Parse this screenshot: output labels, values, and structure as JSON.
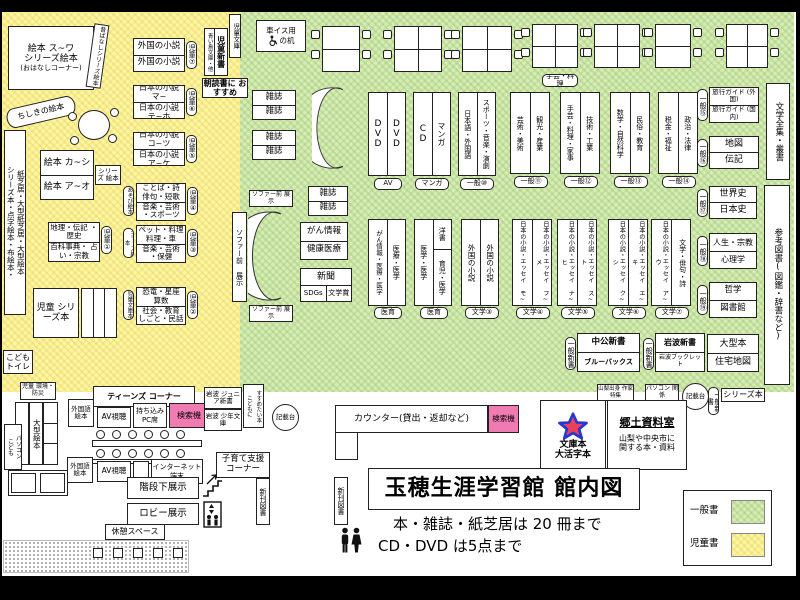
{
  "colors": {
    "general_green": "#d7ecb6",
    "children_yellow": "#fdf6a3",
    "search_pink": "#f07ab2",
    "star_fill": "#e8415c",
    "star_stroke": "#2437d4"
  },
  "labels": {
    "zasshi": "雑誌",
    "shinbun": "新聞",
    "sdgs": "SDGs",
    "bungakusho": "文学賞",
    "av_shicho": "AV視聴",
    "gaikokugo_ehon": "外国語 絵本",
    "kensakuki": "検索機",
    "kisaidai": "記載台",
    "sofa_front": "ソファー前 展示",
    "shinkan": "新刊図書",
    "ippan_shinsho": "一般新書",
    "iiku": "医育",
    "av": "AV",
    "manga": "マンガ"
  },
  "children": {
    "ohanashi": {
      "line1": "絵本 ス~ワ",
      "line2": "シリーズ絵本",
      "line3": "(おはなしコーナー)"
    },
    "mukashi": "昔ばなしシリーズ絵本",
    "chishiki": "ちしきの絵本",
    "left_wall": {
      "line1": "シリーズ本・点字絵本・布絵本・",
      "line2": "紙芝居・大型紙芝居・大型絵本"
    },
    "ehon_ka_shi": {
      "top": "絵本 カ~シ",
      "bottom": "絵本 ア~オ",
      "side": "シリーズ 絵本"
    },
    "foreign_novels": {
      "top": "外国の小説",
      "bottom": "外国の小説",
      "tag": "児童⑦"
    },
    "jidou_shinsho": {
      "main": "児童新書",
      "side": "青い鳥文庫・他",
      "strip": "児童文庫",
      "tag": "朝読書に おすすめ"
    },
    "jp_novels_1": {
      "top": "日本の小説 マ~",
      "bottom": "日本の小説 テ~ホ",
      "tag": "児童⑥"
    },
    "jp_novels_2": {
      "top": "日本の小説 コ~ツ",
      "bottom": "日本の小説 ア~ケ",
      "tag": "児童⑤"
    },
    "kotoba": {
      "top": "ことば・詩 俳句・短歌",
      "bottom": "音楽・芸術 ・スポーツ",
      "tag": "児童④",
      "side": "あそび絵本"
    },
    "pet": {
      "top": "ペット・料理 料理・車",
      "bottom": "音楽・芸術 ・保健",
      "tag": "児童③",
      "side": "シリーズ絵本"
    },
    "kyoryu": {
      "top": "恐竜・星座 算数",
      "bottom": "社会・教育 しごと・民話",
      "tag": "児童②",
      "side": "児童文庫本"
    },
    "chiri": {
      "top": "地理・伝記 ・歴史",
      "bottom": "百科事典・ 占い・宗教",
      "tag": "児童①"
    },
    "jidou_series": "児童 シリーズ本",
    "kodomo_toilet": "こども トイレ",
    "kankyo": "児童 環境・防災",
    "ogata_ehon": "大型絵本",
    "kodomo_pc": {
      "line1": "こども",
      "line2": "パソコン"
    },
    "teens": "ティーンズ コーナー",
    "mochikomi_pc": "持ち込み PC席",
    "iwanami_junior": "岩波 ジュニア新書",
    "iwanami_shonen": "岩波 少年文庫",
    "susume": {
      "line1": "こどもに",
      "line2": "すすめたい本"
    },
    "internet": "インターネット 端末",
    "kosodate": "子育て支援 コーナー"
  },
  "general": {
    "wheelchair_desk": {
      "line1": "車イス用",
      "line2": "の机"
    },
    "shugei_tag": "手芸・料理",
    "row1": [
      {
        "left": "DVD",
        "right": "DVD",
        "tag": "AV"
      },
      {
        "left": "CD",
        "right": "マンガ",
        "tag": "マンガ"
      },
      {
        "left": "日本語・外国語",
        "right": "スポーツ・音楽・演劇",
        "tag": "一般⑩"
      },
      {
        "left": "芸術・美術",
        "right": "観光・産業",
        "tag": "一般⑪"
      },
      {
        "left": "手芸・料理・家事",
        "right": "技術・工業",
        "tag": "一般⑫"
      },
      {
        "left": "数学・自然科学",
        "right": "民俗・教育",
        "tag": "一般⑬"
      },
      {
        "left": "税金・福祉",
        "right": "政治・法律",
        "tag": "一般⑭"
      }
    ],
    "row2": [
      {
        "left": "がん情報・医療・医学",
        "right": "医療・医学",
        "tag": "医育"
      },
      {
        "left": "医学・医学",
        "rtop": "洋書",
        "rbottom": "育児・医学",
        "tag": "医育"
      },
      {
        "left": "外国の小説",
        "right": "外国の小説",
        "tag": "文学③"
      },
      {
        "left": "日本の小説・エッセイ モ~",
        "right": "日本の小説・エッセイ フ~メ",
        "tag": "文学④"
      },
      {
        "left": "日本の小説・エッセイ ナ~ヒ",
        "right": "日本の小説・エッセイ ス~ト",
        "tag": "文学⑤"
      },
      {
        "left": "日本の小説・エッセイ ク~シ",
        "right": "日本の小説・エッセイ エ~キ",
        "tag": "文学⑥"
      },
      {
        "left": "日本の小説・エッセイ ア~ウ",
        "right": "文学・俳句・詩",
        "tag": "文学⑦"
      }
    ],
    "right_col": [
      {
        "tag": "一般⑮",
        "top": "旅行ガイド (外国)",
        "bottom": "旅行ガイド (国内)"
      },
      {
        "tag": "一般⑯",
        "top": "地図",
        "bottom": "伝記"
      },
      {
        "tag": "一般⑰",
        "top": "世界史",
        "bottom": "日本史"
      },
      {
        "tag": "一般⑱",
        "top": "人生・宗教",
        "bottom": "心理学"
      },
      {
        "tag": "一般⑲",
        "top": "哲学",
        "bottom": "図書館"
      }
    ],
    "chuko": {
      "top": "中公新書",
      "bottom": "ブルーバックス"
    },
    "iwanami": {
      "top": "岩波新書",
      "bottom": "岩波ブックレット"
    },
    "ogata_jutaku": {
      "top": "大型本",
      "bottom": "住宅地図"
    },
    "bungaku_zenshu": "文学全集・叢書",
    "sanko_tosho": "参考図書(図鑑・辞書など)",
    "gan_box": {
      "top": "がん情報",
      "bottom": "健康医療"
    },
    "shinbun_box": {
      "top": "新聞",
      "bl": "SDGs",
      "br": "文学賞"
    },
    "yamanashi_tag": "山梨出身 作家特集",
    "pc_kankei": "パソコン 関係",
    "series_bon": "シリーズ本",
    "kyodo": {
      "title": "郷土資料室",
      "body1": "山梨や中央市に",
      "body2": "関する本・資料"
    },
    "bunko": {
      "line1": "文庫本",
      "line2": "大活字本"
    },
    "counter": "カウンター(貸出・返却など)"
  },
  "bottom": {
    "kaidan": "階段下展示",
    "lobby": "ロビー展示",
    "kyukei": "休憩スペース",
    "title": "玉穂生涯学習館 館内図",
    "rule1": "本・雑誌・紙芝居は 20 冊まで",
    "rule2": "CD・DVD は5点まで",
    "legend_general": "一般書",
    "legend_children": "児童書"
  }
}
